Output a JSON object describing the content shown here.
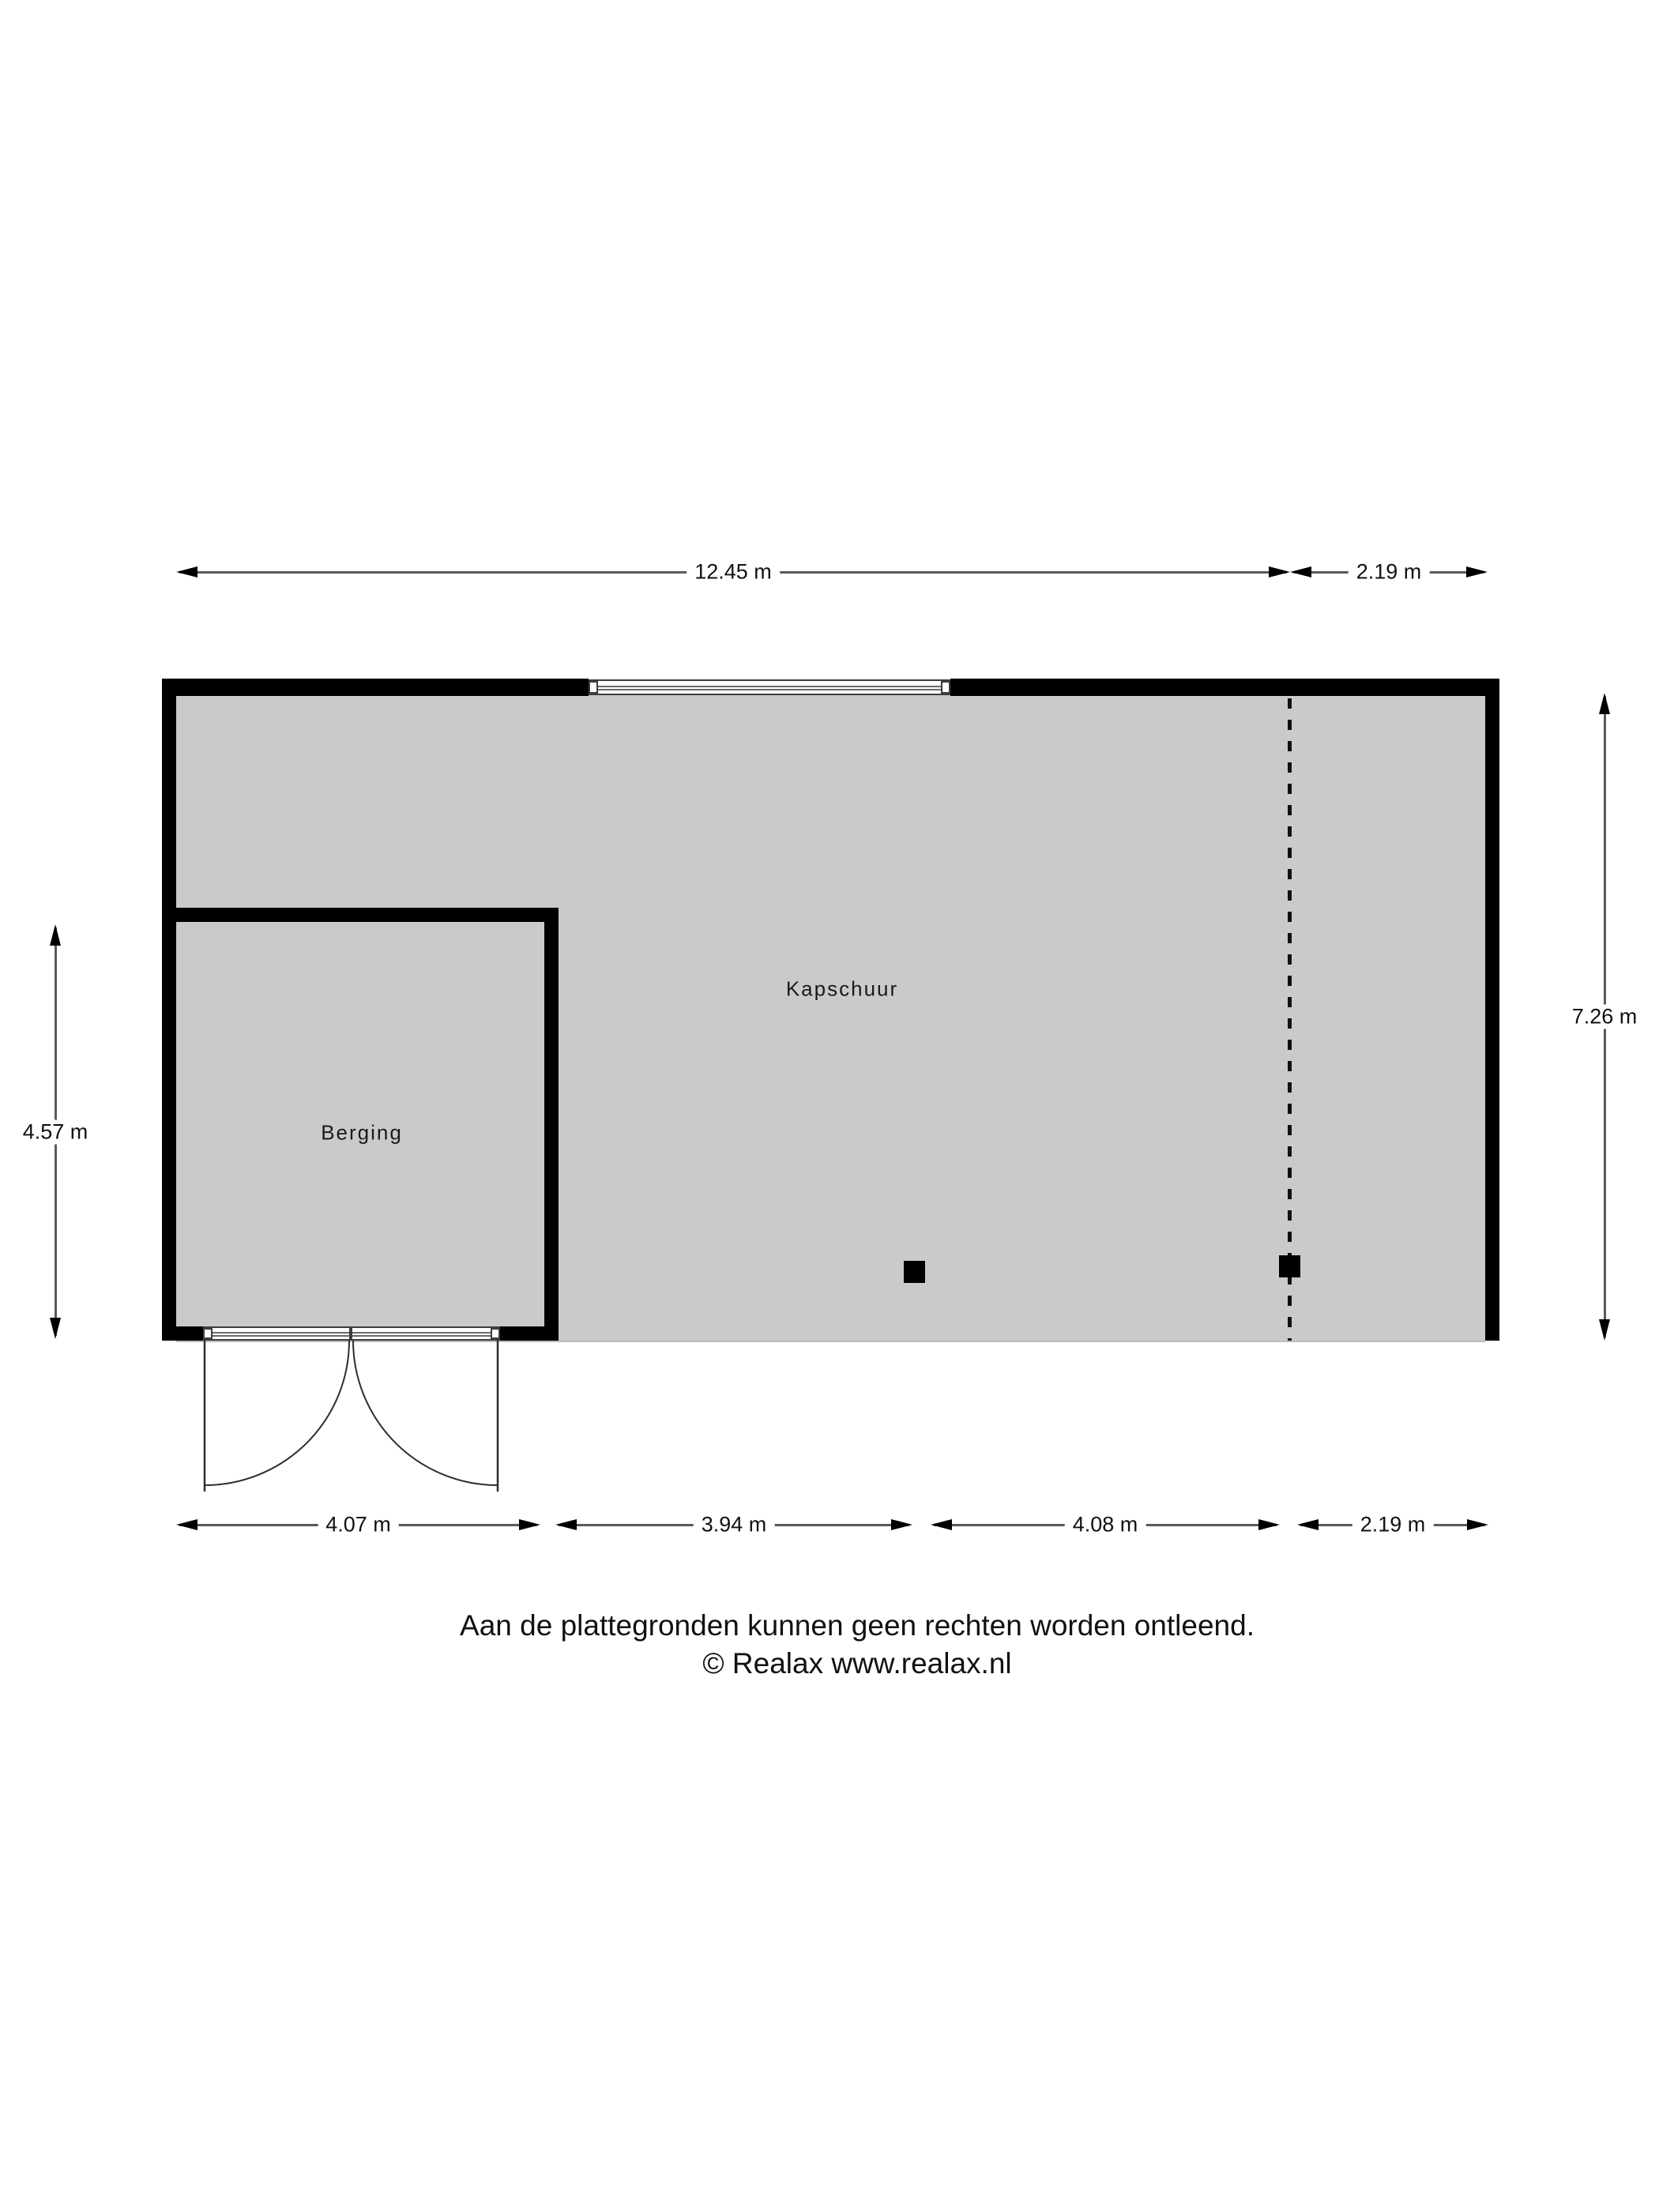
{
  "floorplan": {
    "rooms": [
      {
        "label": "Kapschuur"
      },
      {
        "label": "Berging"
      }
    ],
    "dimensions": {
      "top": [
        {
          "label": "12.45 m"
        },
        {
          "label": "2.19 m"
        }
      ],
      "bottom": [
        {
          "label": "4.07 m"
        },
        {
          "label": "3.94 m"
        },
        {
          "label": "4.08 m"
        },
        {
          "label": "2.19 m"
        }
      ],
      "left": {
        "label": "4.57 m"
      },
      "right": {
        "label": "7.26 m"
      }
    },
    "colors": {
      "floor": "#cacaca",
      "wall": "#000000",
      "dimension_line": "#5a5a5a",
      "background": "#ffffff"
    }
  },
  "footer": {
    "disclaimer": "Aan de plattegronden kunnen geen rechten worden ontleend.",
    "copyright": "© Realax www.realax.nl"
  }
}
